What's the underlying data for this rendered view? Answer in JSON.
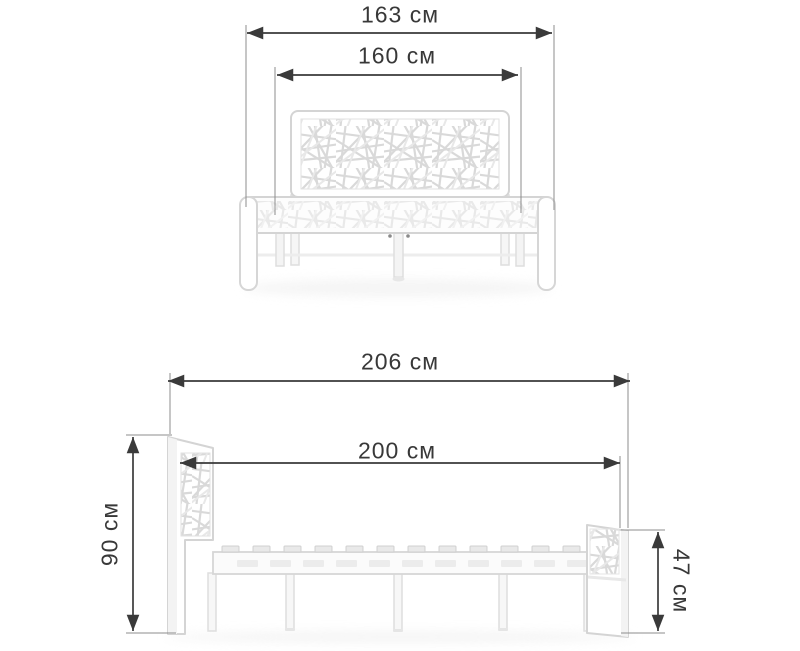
{
  "page": {
    "type": "product-dimensions-diagram",
    "subject": "white metal bed frame with abstract web-pattern headboard, front and side orthographic views",
    "background": "#ffffff"
  },
  "colors": {
    "dimension_line": "#3a3a3a",
    "extension_line": "#8c8c8c",
    "label_text": "#383838",
    "bed_outline": "#d4d4d4",
    "bed_fill": "#ffffff",
    "web_pattern": "#d9d9d9",
    "shadow": "#ededed"
  },
  "views": {
    "front": {
      "name": "front-view",
      "dimensions": {
        "overall_width": {
          "label": "163 см",
          "value": 163,
          "unit": "см",
          "orientation": "horizontal"
        },
        "sleeping_width": {
          "label": "160 см",
          "value": 160,
          "unit": "см",
          "orientation": "horizontal"
        }
      }
    },
    "side": {
      "name": "side-view",
      "dimensions": {
        "overall_length": {
          "label": "206 см",
          "value": 206,
          "unit": "см",
          "orientation": "horizontal"
        },
        "sleeping_length": {
          "label": "200 см",
          "value": 200,
          "unit": "см",
          "orientation": "horizontal"
        },
        "headboard_height": {
          "label": "90 см",
          "value": 90,
          "unit": "см",
          "orientation": "vertical"
        },
        "footboard_height": {
          "label": "47 см",
          "value": 47,
          "unit": "см",
          "orientation": "vertical"
        }
      }
    }
  }
}
